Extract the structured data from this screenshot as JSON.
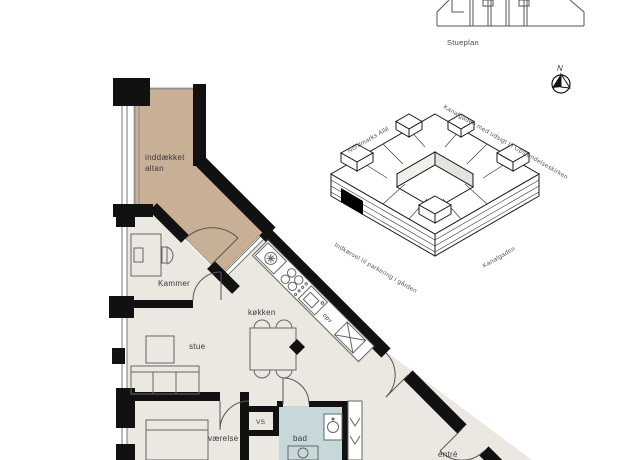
{
  "colors": {
    "background": "#ffffff",
    "wall": "#111111",
    "floor": "#ebe8e2",
    "balcony_fill": "#c8b096",
    "bathroom_fill": "#c7d8db",
    "line": "#666666",
    "text": "#3a3a3a"
  },
  "overview": {
    "title": "Stueplan"
  },
  "compass": {
    "label": "N"
  },
  "site_model": {
    "streets": [
      {
        "id": "nordmarks-alle",
        "label": "Nordmarks Allé"
      },
      {
        "id": "kanalgaden-view",
        "label": "Kanalgaden med udsigt til Opstandelseskirken"
      },
      {
        "id": "parking-entrance",
        "label": "Indkørsel til parkering i gården"
      },
      {
        "id": "kanalgaden",
        "label": "Kanalgaden"
      }
    ],
    "marker": "apartment-location"
  },
  "floor_plan": {
    "rooms": {
      "altan": {
        "line1": "inddækket",
        "line2": "altan"
      },
      "kammer": {
        "label": "Kammer"
      },
      "koekken": {
        "label": "køkken"
      },
      "stue": {
        "label": "stue"
      },
      "vaerelse": {
        "label": "værelse"
      },
      "vs": {
        "label": "VS"
      },
      "bad": {
        "label": "bad"
      },
      "entre": {
        "label": "entré"
      }
    },
    "kitchen": {
      "dishwasher_label": "opv"
    }
  }
}
